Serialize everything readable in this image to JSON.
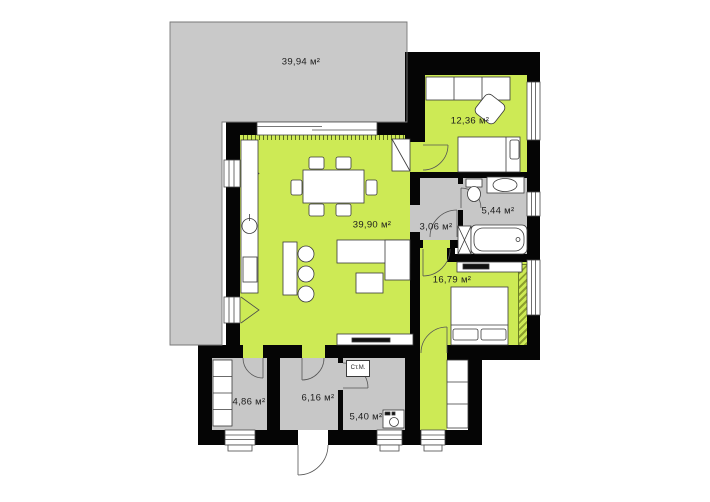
{
  "plan_type": "floor-plan",
  "colors": {
    "room_green": "#cdea55",
    "terrace_gray": "#c9c9c9",
    "utility_gray": "#c7c7c7",
    "wall_black": "#050505"
  },
  "rooms": {
    "terrace": {
      "area": "39,94 м²"
    },
    "bedroom2": {
      "area": "12,36 м²"
    },
    "living": {
      "area": "39,90 м²"
    },
    "hall": {
      "area": "3,06 м²"
    },
    "bathroom": {
      "area": "5,44 м²"
    },
    "bedroom1": {
      "area": "16,79 м²"
    },
    "pantry": {
      "area": "4,86 м²"
    },
    "entry": {
      "area": "6,16 м²"
    },
    "utility": {
      "area": "5,40 м²"
    }
  },
  "labels": {
    "washing_machine": "Ст.М."
  }
}
